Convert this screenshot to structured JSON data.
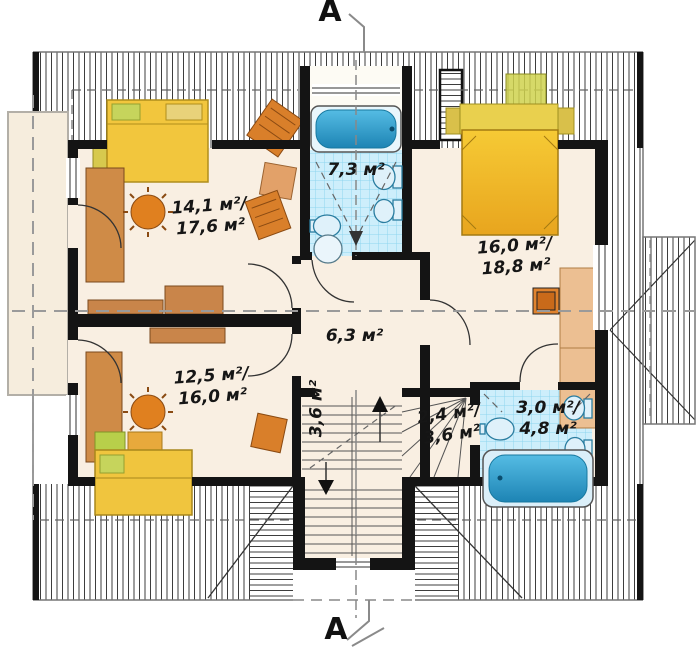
{
  "section_marks": {
    "top": "A",
    "bottom": "A"
  },
  "room_labels": {
    "study_top_left": {
      "line1": "14,1 м²/",
      "line2": "17,6 м²"
    },
    "bathroom_main": {
      "line1": "7,3 м²"
    },
    "bedroom_right": {
      "line1": "16,0 м²/",
      "line2": "18,8 м²"
    },
    "hall_center": {
      "line1": "6,3 м²"
    },
    "room_bottom_left": {
      "line1": "12,5 м²/",
      "line2": "16,0 м²"
    },
    "stair_flight": {
      "line1": "3,6 м²"
    },
    "stair_landing": {
      "line1": "2,4 м²/",
      "line2": "3,6 м²"
    },
    "bathroom_small": {
      "line1": "3,0 м²/",
      "line2": "4,8 м²"
    }
  },
  "colors": {
    "floor": "#f9efe2",
    "annex_floor": "#f6eddd",
    "bathroom_floor": "#fdfbf4",
    "wall": "#141414",
    "tile_base": "#cdeefb",
    "tile_grid": "#8ed5ef",
    "water_blue": "#3fa9d6",
    "fixture_blue": "#dff1fa",
    "furniture_wood": "#cf8b47",
    "furniture_orange": "#e0801f",
    "bed_yellow": "#f2c63d",
    "pillow_green": "#c6d45c",
    "wardrobe_tan": "#ecbf92",
    "dashed_line": "#9a9a9a"
  }
}
